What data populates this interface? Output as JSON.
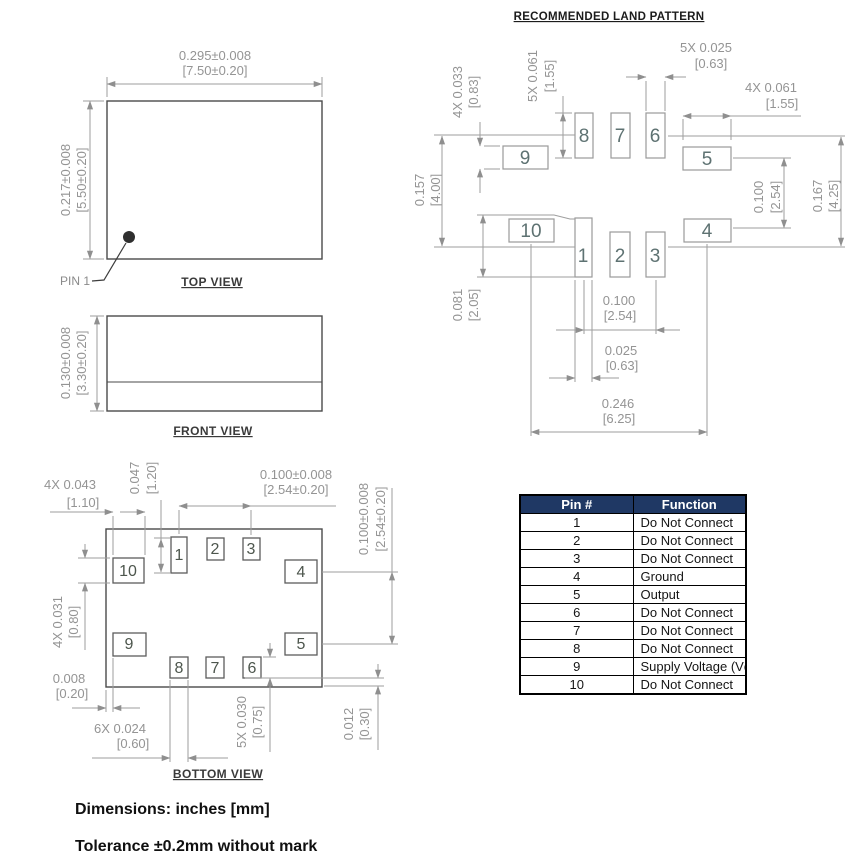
{
  "top_view": {
    "title": "TOP VIEW",
    "pin1": "PIN 1",
    "w": [
      "0.295±0.008",
      "[7.50±0.20]"
    ],
    "h": [
      "0.217±0.008",
      "[5.50±0.20]"
    ]
  },
  "front_view": {
    "title": "FRONT VIEW",
    "h": [
      "0.130±0.008",
      "[3.30±0.20]"
    ]
  },
  "bottom_view": {
    "title": "BOTTOM VIEW",
    "pads": [
      "1",
      "2",
      "3",
      "4",
      "5",
      "6",
      "7",
      "8",
      "9",
      "10"
    ],
    "dims": {
      "corner": [
        "4X 0.043",
        "[1.10]"
      ],
      "pad1": [
        "0.047",
        "[1.20]"
      ],
      "pitch": [
        "0.100±0.008",
        "[2.54±0.20]"
      ],
      "pitch_r": [
        "0.100±0.008",
        "[2.54±0.20]"
      ],
      "side_h": [
        "4X 0.031",
        "[0.80]"
      ],
      "gap": [
        "0.008",
        "[0.20]"
      ],
      "pad_w": [
        "6X 0.024",
        "[0.60]"
      ],
      "pad_h": [
        "5X 0.030",
        "[0.75]"
      ],
      "offset": [
        "0.012",
        "[0.30]"
      ]
    }
  },
  "land_pattern": {
    "title": "RECOMMENDED LAND PATTERN",
    "pads": [
      "1",
      "2",
      "3",
      "4",
      "5",
      "6",
      "7",
      "8",
      "9",
      "10"
    ],
    "dims": {
      "side_h": [
        "4X 0.033",
        "[0.83]"
      ],
      "top_len": [
        "5X 0.061",
        "[1.55]"
      ],
      "top_w": [
        "5X 0.025",
        "[0.63]"
      ],
      "side_len": [
        "4X 0.061",
        "[1.55]"
      ],
      "span_l": [
        "0.157",
        "[4.00]"
      ],
      "pad1": [
        "0.081",
        "[2.05]"
      ],
      "pitch_r": [
        "0.100",
        "[2.54]"
      ],
      "span_r": [
        "0.167",
        "[4.25]"
      ],
      "pitch_b": [
        "0.100",
        "[2.54]"
      ],
      "pad1_w": [
        "0.025",
        "[0.63]"
      ],
      "total": [
        "0.246",
        "[6.25]"
      ]
    }
  },
  "pin_table": {
    "headers": [
      "Pin #",
      "Function"
    ],
    "rows": [
      [
        "1",
        "Do Not Connect"
      ],
      [
        "2",
        "Do Not Connect"
      ],
      [
        "3",
        "Do Not Connect"
      ],
      [
        "4",
        "Ground"
      ],
      [
        "5",
        "Output"
      ],
      [
        "6",
        "Do Not Connect"
      ],
      [
        "7",
        "Do Not Connect"
      ],
      [
        "8",
        "Do Not Connect"
      ],
      [
        "9",
        "Supply Voltage (Vdd)"
      ],
      [
        "10",
        "Do Not Connect"
      ]
    ]
  },
  "footer": {
    "line1": "Dimensions: inches [mm]",
    "line2": "Tolerance ±0.2mm without mark"
  },
  "colors": {
    "dim_line": "#9e9e9e",
    "dim_text": "#949494",
    "outline": "#4a4a4a",
    "table_header_bg": "#1f3864",
    "table_header_text": "#ffffff"
  }
}
